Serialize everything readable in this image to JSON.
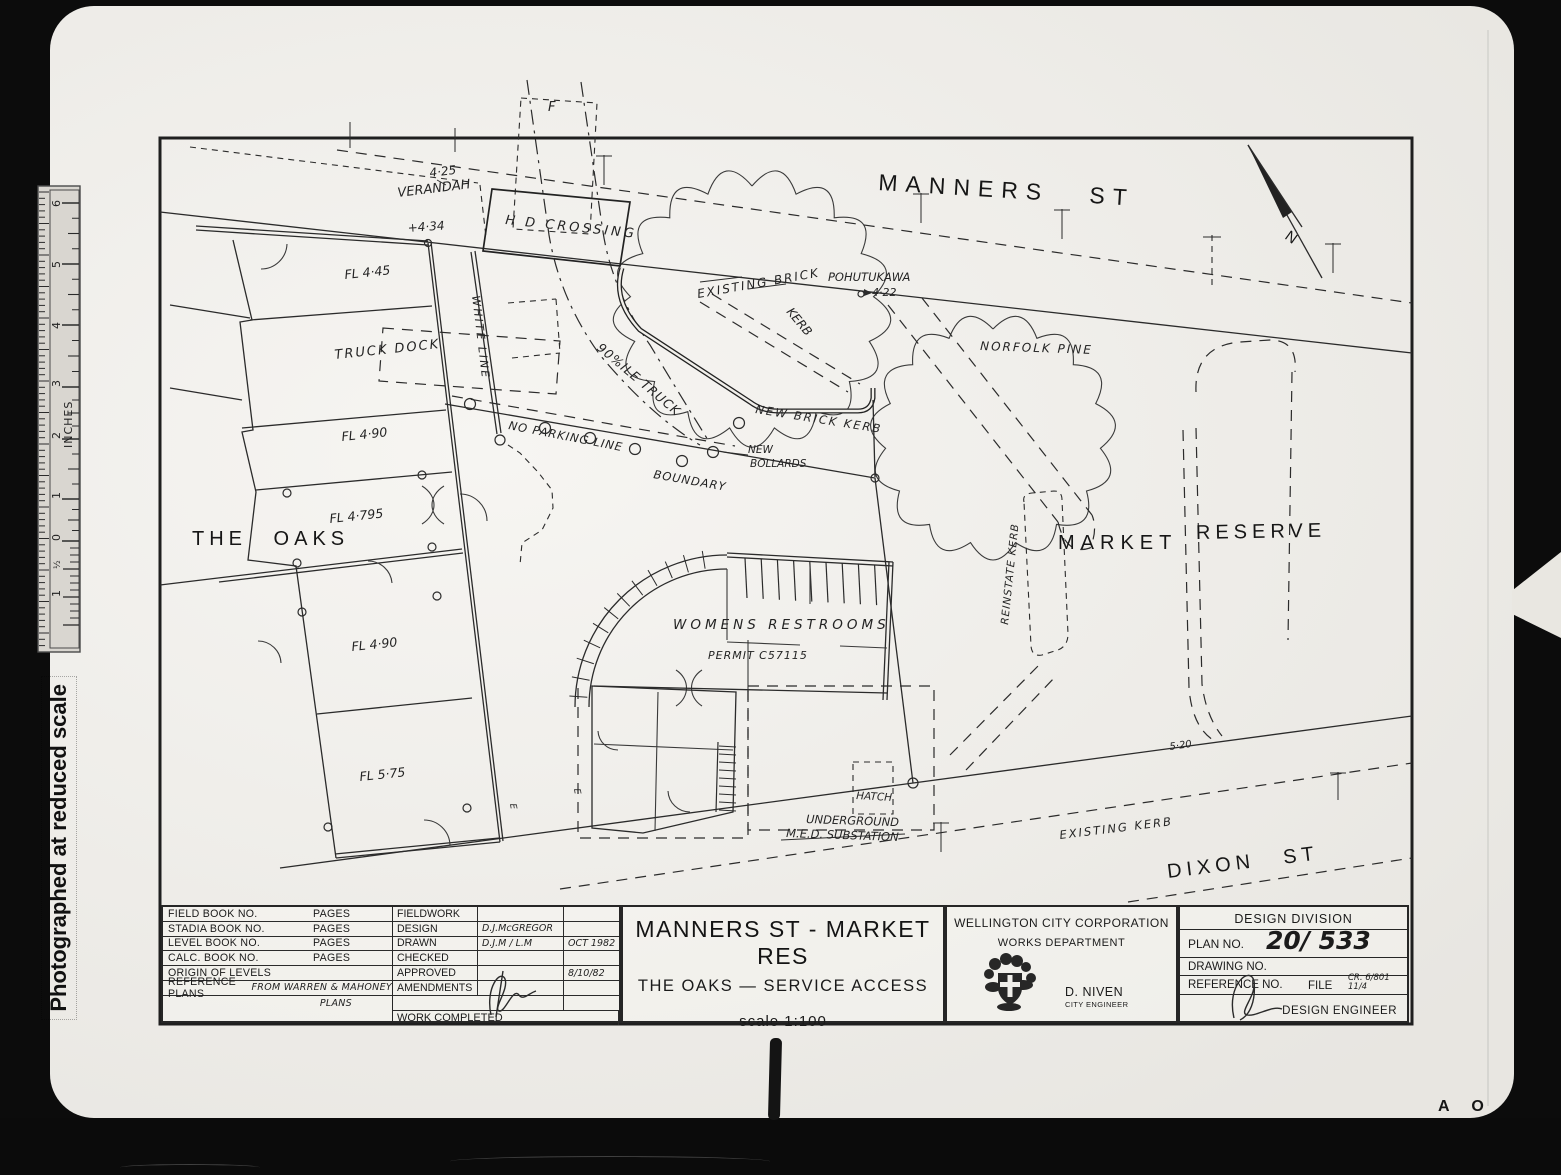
{
  "colors": {
    "paper": "#f2f0eb",
    "ink": "#1c1c1c",
    "scan_black": "#0c0c0c"
  },
  "scan": {
    "note": "Photographed at reduced scale",
    "artifact_letters": "A O",
    "ruler": {
      "unit": "INCHES",
      "labels": [
        "6",
        "5",
        "4",
        "3",
        "2",
        "1",
        "0",
        "½",
        "1"
      ]
    }
  },
  "plan": {
    "streets": {
      "manners": "MANNERS ST",
      "dixon": "DIXON ST"
    },
    "areas": {
      "the_oaks": "THE OAKS",
      "market": "MARKET",
      "reserve": "RESERVE"
    },
    "labels": {
      "f_mark": "F",
      "lvl_425": "4·25",
      "verandah": "VERANDAH",
      "lvl_434": "+4·34",
      "hd_crossing": "H D CROSSING",
      "white_line": "WHITE LINE",
      "existing_brick": "EXISTING BRICK",
      "kerb": "KERB",
      "pohutukawa": "POHUTUKAWA",
      "lvl_422": "4·22",
      "norfolk_pine": "NORFOLK PINE",
      "truck_dock": "TRUCK DOCK",
      "fl_445": "FL 4·45",
      "fl_490a": "FL 4·90",
      "fl_4795": "FL 4·795",
      "fl_490b": "FL 4·90",
      "fl_575": "FL 5·75",
      "ninety_truck": "90%ILE TRUCK",
      "no_parking": "NO PARKING LINE",
      "new_brick_kerb": "NEW BRICK KERB",
      "new": "NEW",
      "bollards": "BOLLARDS",
      "boundary": "BOUNDARY",
      "womens_restrooms": "WOMENS  RESTROOMS",
      "permit": "PERMIT C57115",
      "reinstate_kerb": "REINSTATE KERB",
      "hatch": "HATCH",
      "underground": "UNDERGROUND",
      "med_substation": "M.E.D. SUBSTATION",
      "existing_kerb": "EXISTING KERB",
      "lvl_520": "5·20",
      "north": "N",
      "e_marker": "E"
    }
  },
  "title_block": {
    "books": [
      {
        "label": "FIELD BOOK NO.",
        "pages": "PAGES"
      },
      {
        "label": "STADIA BOOK NO.",
        "pages": "PAGES"
      },
      {
        "label": "LEVEL BOOK NO.",
        "pages": "PAGES"
      },
      {
        "label": "CALC. BOOK NO.",
        "pages": "PAGES"
      }
    ],
    "origin_label": "ORIGIN OF LEVELS",
    "reference_label": "REFERENCE PLANS",
    "reference_value_1": "FROM WARREN & MAHONEY",
    "reference_value_2": "PLANS",
    "work": {
      "fieldwork": "FIELDWORK",
      "design": "DESIGN",
      "design_by": "D.J.McGREGOR",
      "drawn": "DRAWN",
      "drawn_by": "D.J.M / L.M",
      "drawn_date": "OCT 1982",
      "checked": "CHECKED",
      "approved": "APPROVED",
      "approved_date": "8/10/82",
      "amendments": "AMENDMENTS",
      "work_completed": "WORK COMPLETED"
    },
    "title": {
      "line1": "MANNERS ST - MARKET RES",
      "line2": "THE OAKS — SERVICE ACCESS",
      "scale": "scale  1:100"
    },
    "org": {
      "name": "WELLINGTON CITY CORPORATION",
      "dept": "WORKS DEPARTMENT",
      "engineer": "D. NIVEN",
      "engineer_title": "CITY ENGINEER"
    },
    "division": {
      "name": "DESIGN DIVISION",
      "plan_no_label": "PLAN NO.",
      "plan_no": "20/ 533",
      "drawing_no_label": "DRAWING NO.",
      "reference_no_label": "REFERENCE NO.",
      "file_label": "FILE",
      "file_no1": "CR. 6/801",
      "file_no2": "11/4",
      "design_engineer": "DESIGN ENGINEER"
    }
  }
}
